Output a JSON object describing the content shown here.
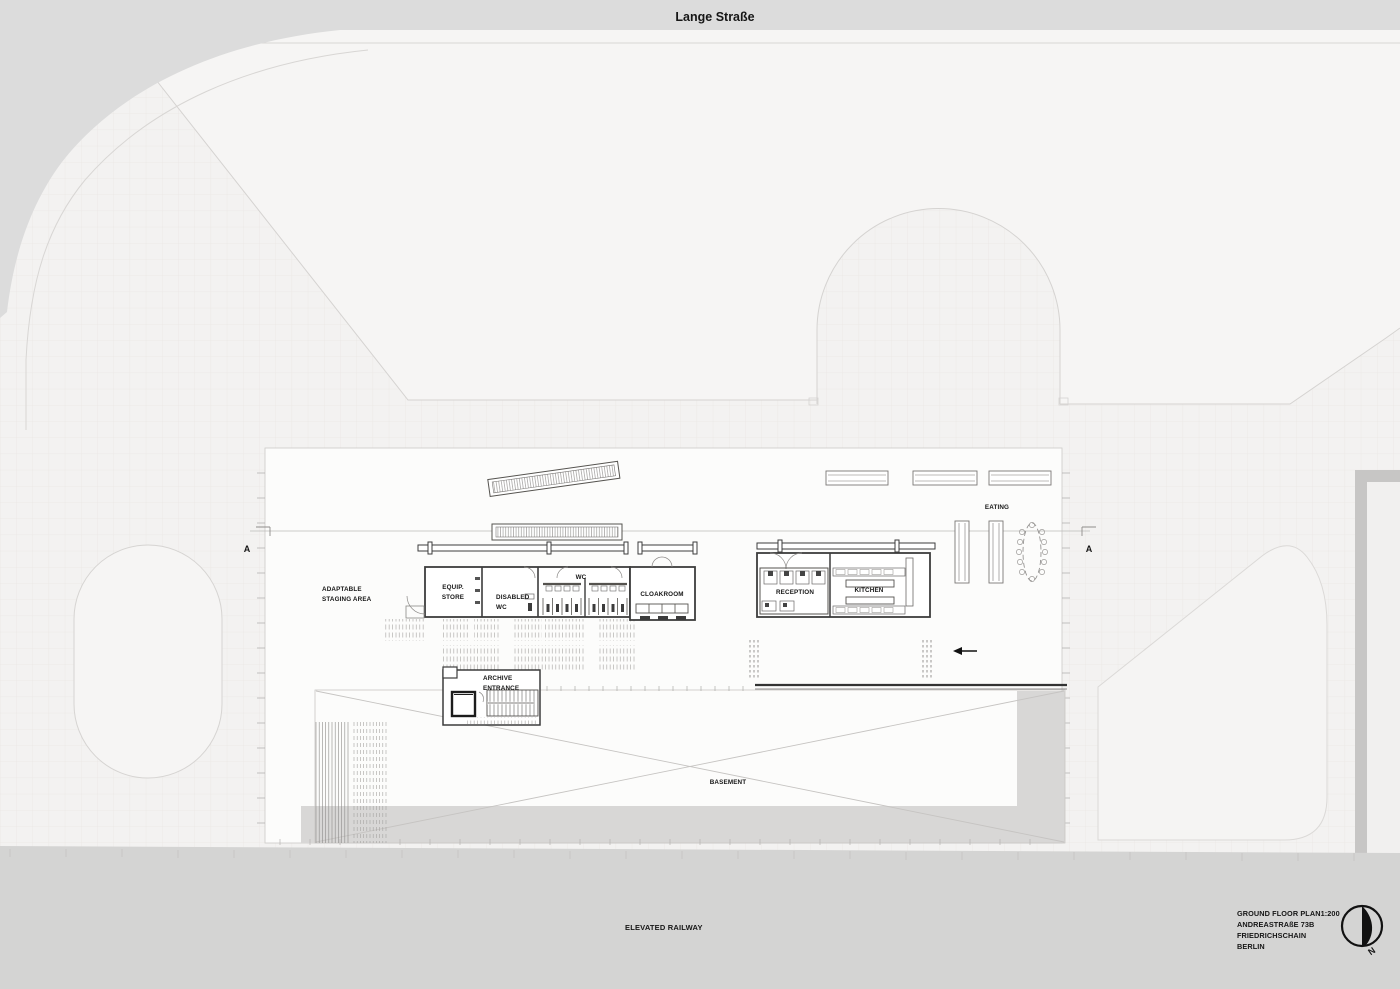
{
  "street": {
    "name": "Lange Straße"
  },
  "railway": {
    "label": "ELEVATED RAILWAY"
  },
  "section": {
    "left": "A",
    "right": "A"
  },
  "rooms": {
    "staging_l1": "ADAPTABLE",
    "staging_l2": "STAGING AREA",
    "equip_l1": "EQUIP.",
    "equip_l2": "STORE",
    "disabled_l1": "DISABLED",
    "disabled_l2": "WC",
    "wc": "WC",
    "cloakroom": "CLOAKROOM",
    "reception": "RECEPTION",
    "kitchen": "KITCHEN",
    "eating": "EATING",
    "archive_l1": "ARCHIVE",
    "archive_l2": "ENTRANCE",
    "basement": "BASEMENT"
  },
  "title_block": {
    "l1": "GROUND FLOOR PLAN1:200",
    "l2": "ANDREASTRAßE 73B",
    "l3": "FRIEDRICHSCHAIN",
    "l4": "BERLIN"
  },
  "compass": {
    "label": "N"
  },
  "colors": {
    "street_band": "#dcdcdc",
    "railway_band": "#d4d4d3",
    "shadow_gray": "#d8d7d6",
    "wall_dark": "#3c3c3c",
    "site_line": "#d5d3d1",
    "plan_bg": "#f3f2f1"
  }
}
